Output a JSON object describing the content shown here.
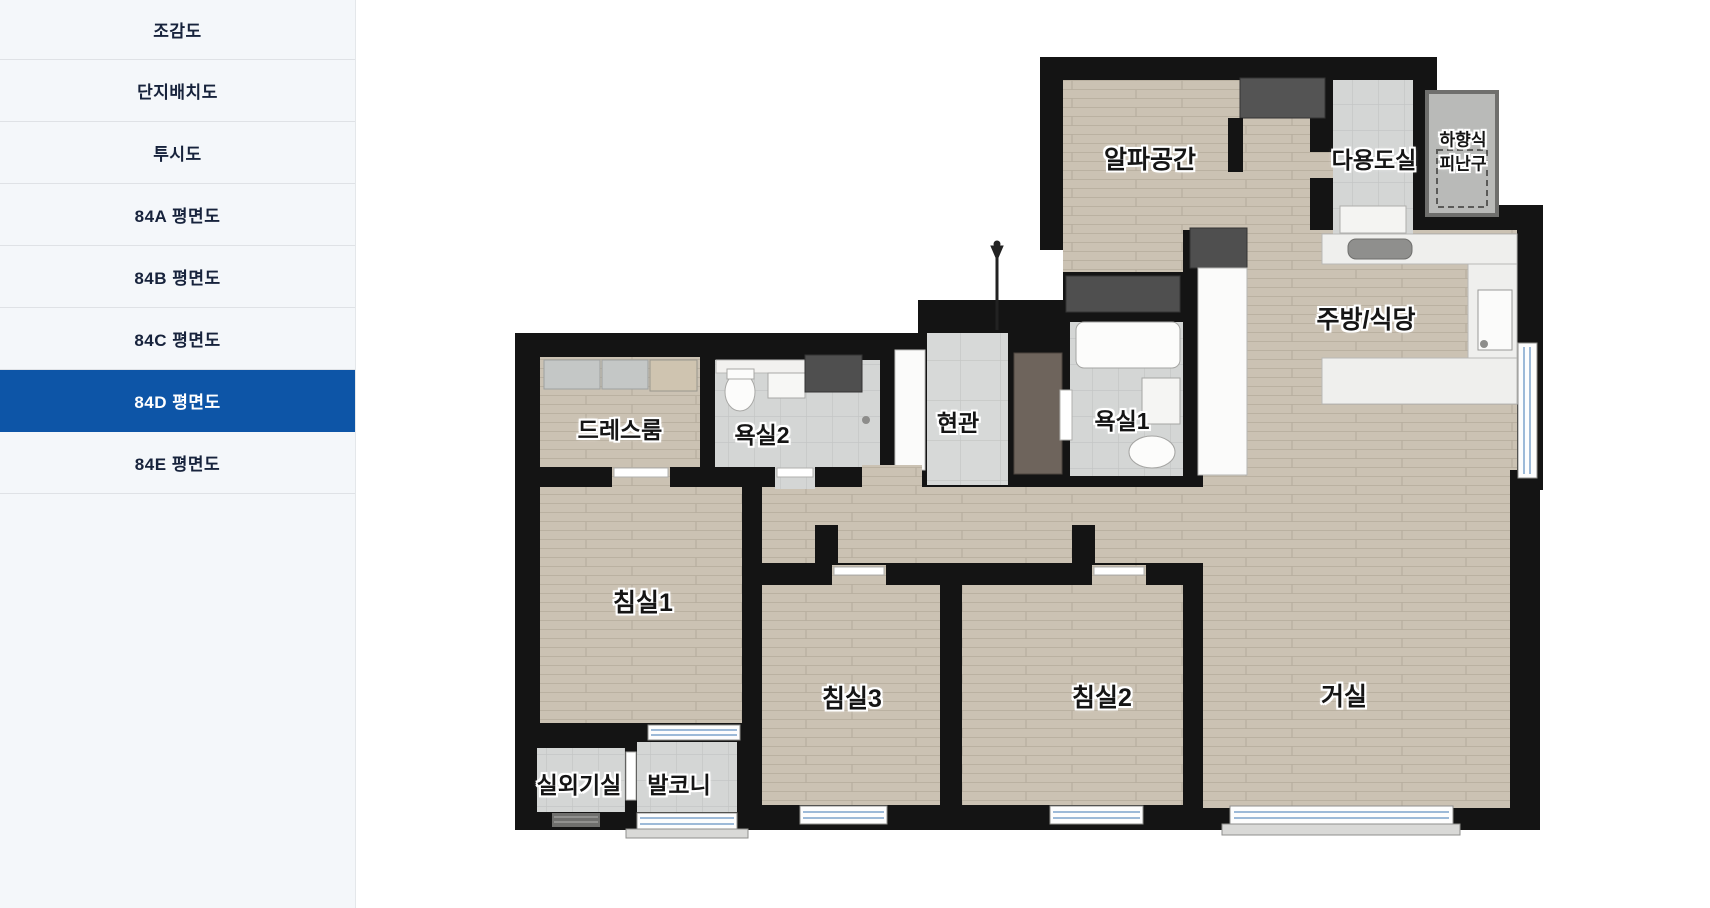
{
  "sidebar": {
    "items": [
      {
        "label": "조감도",
        "active": false
      },
      {
        "label": "단지배치도",
        "active": false
      },
      {
        "label": "투시도",
        "active": false
      },
      {
        "label": "84A 평면도",
        "active": false
      },
      {
        "label": "84B 평면도",
        "active": false
      },
      {
        "label": "84C 평면도",
        "active": false
      },
      {
        "label": "84D 평면도",
        "active": true
      },
      {
        "label": "84E 평면도",
        "active": false
      }
    ],
    "active_color": "#0d55a7"
  },
  "floorplan": {
    "title": "84D 평면도",
    "labels": {
      "alpha_space": "알파공간",
      "utility_room": "다용도실",
      "hatch_line1": "하향식",
      "hatch_line2": "피난구",
      "kitchen_dining": "주방/식당",
      "dress_room": "드레스룸",
      "bathroom2": "욕실2",
      "entrance": "현관",
      "bathroom1": "욕실1",
      "bedroom1": "침실1",
      "bedroom3": "침실3",
      "bedroom2": "침실2",
      "living_room": "거실",
      "outdoor_unit_room": "실외기실",
      "balcony": "발코니"
    },
    "colors": {
      "wall": "#141414",
      "wood_floor": "#cbc2b3",
      "tile_floor": "#d4d6d5"
    }
  }
}
